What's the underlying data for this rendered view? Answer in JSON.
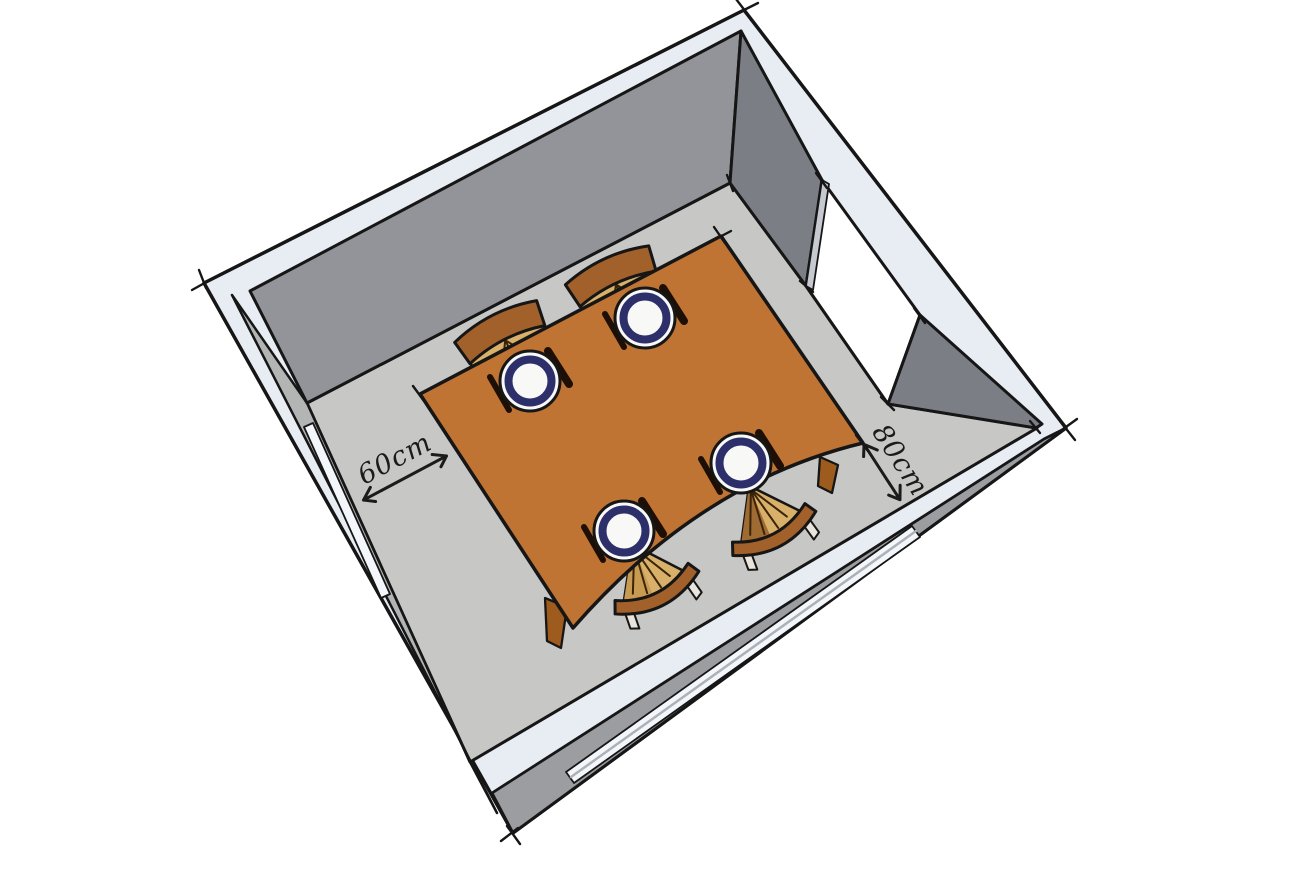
{
  "diagram": {
    "type": "3d-room-sketch",
    "subject": "dining room viewed from above with a table for four",
    "annotations": [
      {
        "id": "left-clearance",
        "label": "60cm"
      },
      {
        "id": "right-clearance",
        "label": "80cm"
      }
    ],
    "room": {
      "walls": [
        "back",
        "right",
        "front",
        "left"
      ],
      "openings": [
        {
          "kind": "doorway",
          "wall": "right",
          "state": "open"
        },
        {
          "kind": "window",
          "wall": "front"
        },
        {
          "kind": "window",
          "wall": "left"
        }
      ]
    },
    "furniture": {
      "table": {
        "shape": "rectangular",
        "color": "#bf7434",
        "legs_visible": 2
      },
      "chairs": [
        {
          "position": "back-left"
        },
        {
          "position": "back-right"
        },
        {
          "position": "front-left"
        },
        {
          "position": "front-right"
        }
      ],
      "place_settings": {
        "count": 4,
        "items": [
          "plate",
          "fork",
          "knife"
        ]
      }
    },
    "colors": {
      "floor": "#c7c7c6",
      "wall_back": "#939499",
      "wall_right": "#7b7e84",
      "wall_top_edge": "#e8ecf3",
      "wall_exterior": "#9b9da1",
      "wall_side_face": "#b3b5b5",
      "window": "#f3f7fb",
      "table": "#bf7434",
      "table_leg": "#9d5b1e",
      "chair_back": "#a2602b",
      "chair_seat": "#d9b06a",
      "plate_rim": "#2d2f6a",
      "outline": "#161616"
    }
  }
}
